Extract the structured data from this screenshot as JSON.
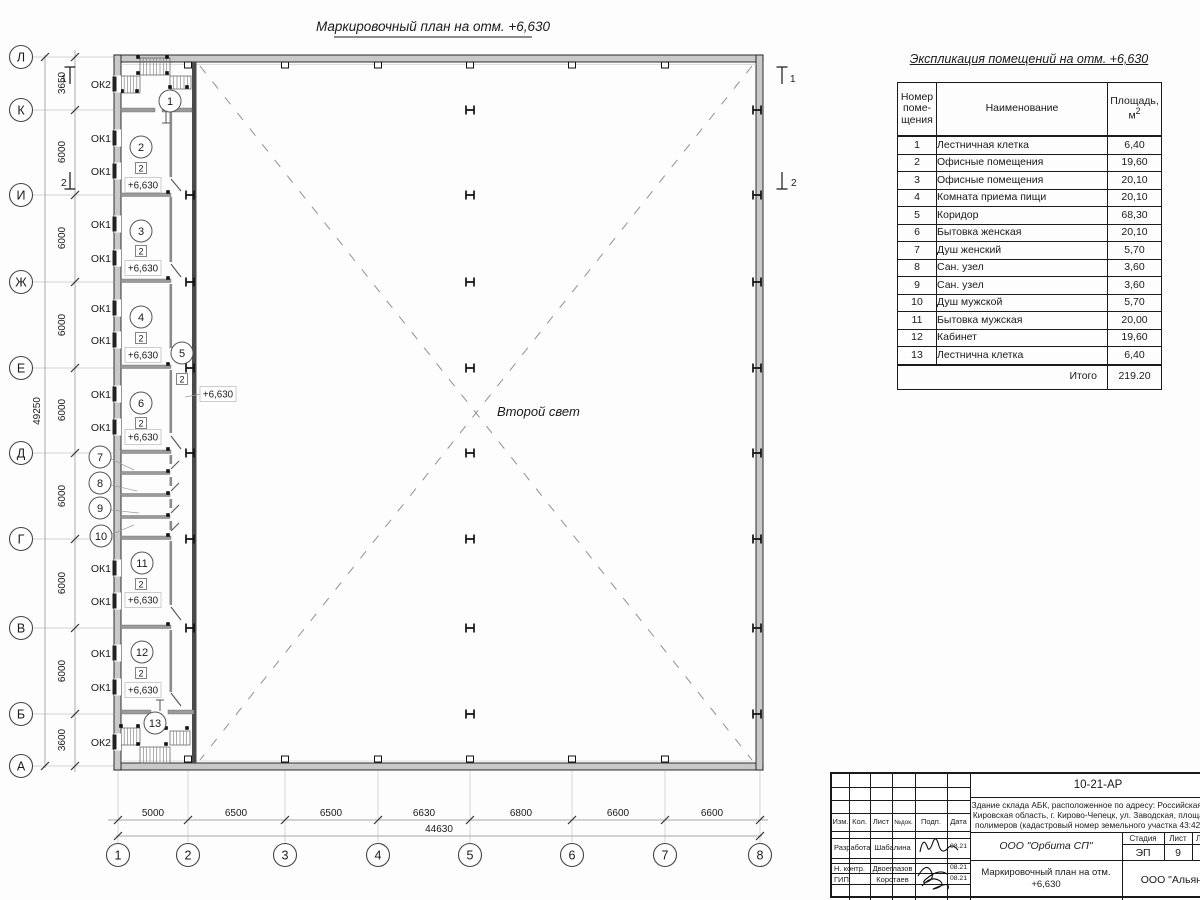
{
  "plan": {
    "title": "Маркировочный план на отм. +6,630",
    "second_light_label": "Второй свет",
    "level_mark": "+6,630",
    "room_type_label": "2",
    "axes_rows": [
      "Л",
      "К",
      "И",
      "Ж",
      "Е",
      "Д",
      "Г",
      "В",
      "Б",
      "А"
    ],
    "axes_cols": [
      "1",
      "2",
      "3",
      "4",
      "5",
      "6",
      "7",
      "8"
    ],
    "dims_left": [
      "3650",
      "6000",
      "6000",
      "6000",
      "6000",
      "6000",
      "6000",
      "6000",
      "3600"
    ],
    "dim_left_total": "49250",
    "dims_bottom": [
      "5000",
      "6500",
      "6500",
      "6630",
      "6800",
      "6600",
      "6600"
    ],
    "dim_bottom_total": "44630",
    "window_labels": [
      "ОК2",
      "ОК1",
      "ОК1",
      "ОК1",
      "ОК1",
      "ОК1",
      "ОК1",
      "ОК1",
      "ОК1",
      "ОК1",
      "ОК1",
      "ОК1",
      "ОК1",
      "ОК2"
    ],
    "room_numbers": [
      "1",
      "2",
      "3",
      "4",
      "5",
      "6",
      "7",
      "8",
      "9",
      "10",
      "11",
      "12",
      "13"
    ],
    "section_marks": [
      "1",
      "2"
    ]
  },
  "schedule": {
    "title": "Экспликация помещений на отм. +6,630",
    "header": {
      "number": "Номер поме- щения",
      "name": "Наименование",
      "area_line1": "Площадь,",
      "area_unit": "м",
      "area_sup": "2"
    },
    "rows": [
      {
        "num": "1",
        "name": "Лестничная клетка",
        "area": "6,40"
      },
      {
        "num": "2",
        "name": "Офисные помещения",
        "area": "19,60"
      },
      {
        "num": "3",
        "name": "Офисные помещения",
        "area": "20,10"
      },
      {
        "num": "4",
        "name": "Комната приема пищи",
        "area": "20,10"
      },
      {
        "num": "5",
        "name": "Коридор",
        "area": "68,30"
      },
      {
        "num": "6",
        "name": "Бытовка женская",
        "area": "20,10"
      },
      {
        "num": "7",
        "name": "Душ женский",
        "area": "5,70"
      },
      {
        "num": "8",
        "name": "Сан. узел",
        "area": "3,60"
      },
      {
        "num": "9",
        "name": "Сан. узел",
        "area": "3,60"
      },
      {
        "num": "10",
        "name": "Душ мужской",
        "area": "5,70"
      },
      {
        "num": "11",
        "name": "Бытовка мужская",
        "area": "20,00"
      },
      {
        "num": "12",
        "name": "Кабинет",
        "area": "19,60"
      },
      {
        "num": "13",
        "name": "Лестнична клетка",
        "area": "6,40"
      }
    ],
    "total_label": "Итого",
    "total_value": "219.20"
  },
  "titleblock": {
    "doc_code": "10-21-АР",
    "desc_lines": [
      "Здание склада АБК, расположенное по адресу: Российская Феде",
      "Кировская область, г. Кирово-Чепецк, ул. Заводская, площадка з",
      "полимеров (кадастровый номер земельного участка 43:42:0000"
    ],
    "cols": [
      "Изм.",
      "Кол.",
      "Лист",
      "№док.",
      "Подп.",
      "Дата"
    ],
    "roles": [
      {
        "role": "Разработал",
        "name": "Шабалина",
        "date": "08.21"
      },
      {
        "role": "Н. контр.",
        "name": "Двоеглазов",
        "date": "08.21"
      },
      {
        "role": "ГИП",
        "name": "Коротаев",
        "date": "08.21"
      }
    ],
    "org": "ООО \"Орбита СП\"",
    "sheet_title": "Маркировочный план на отм. +6,630",
    "stage_label": "Стадия",
    "list_label": "Лист",
    "lists_label": "Листов",
    "stage": "ЭП",
    "list": "9",
    "lists": "1",
    "org2": "ООО \"Альянс"
  }
}
